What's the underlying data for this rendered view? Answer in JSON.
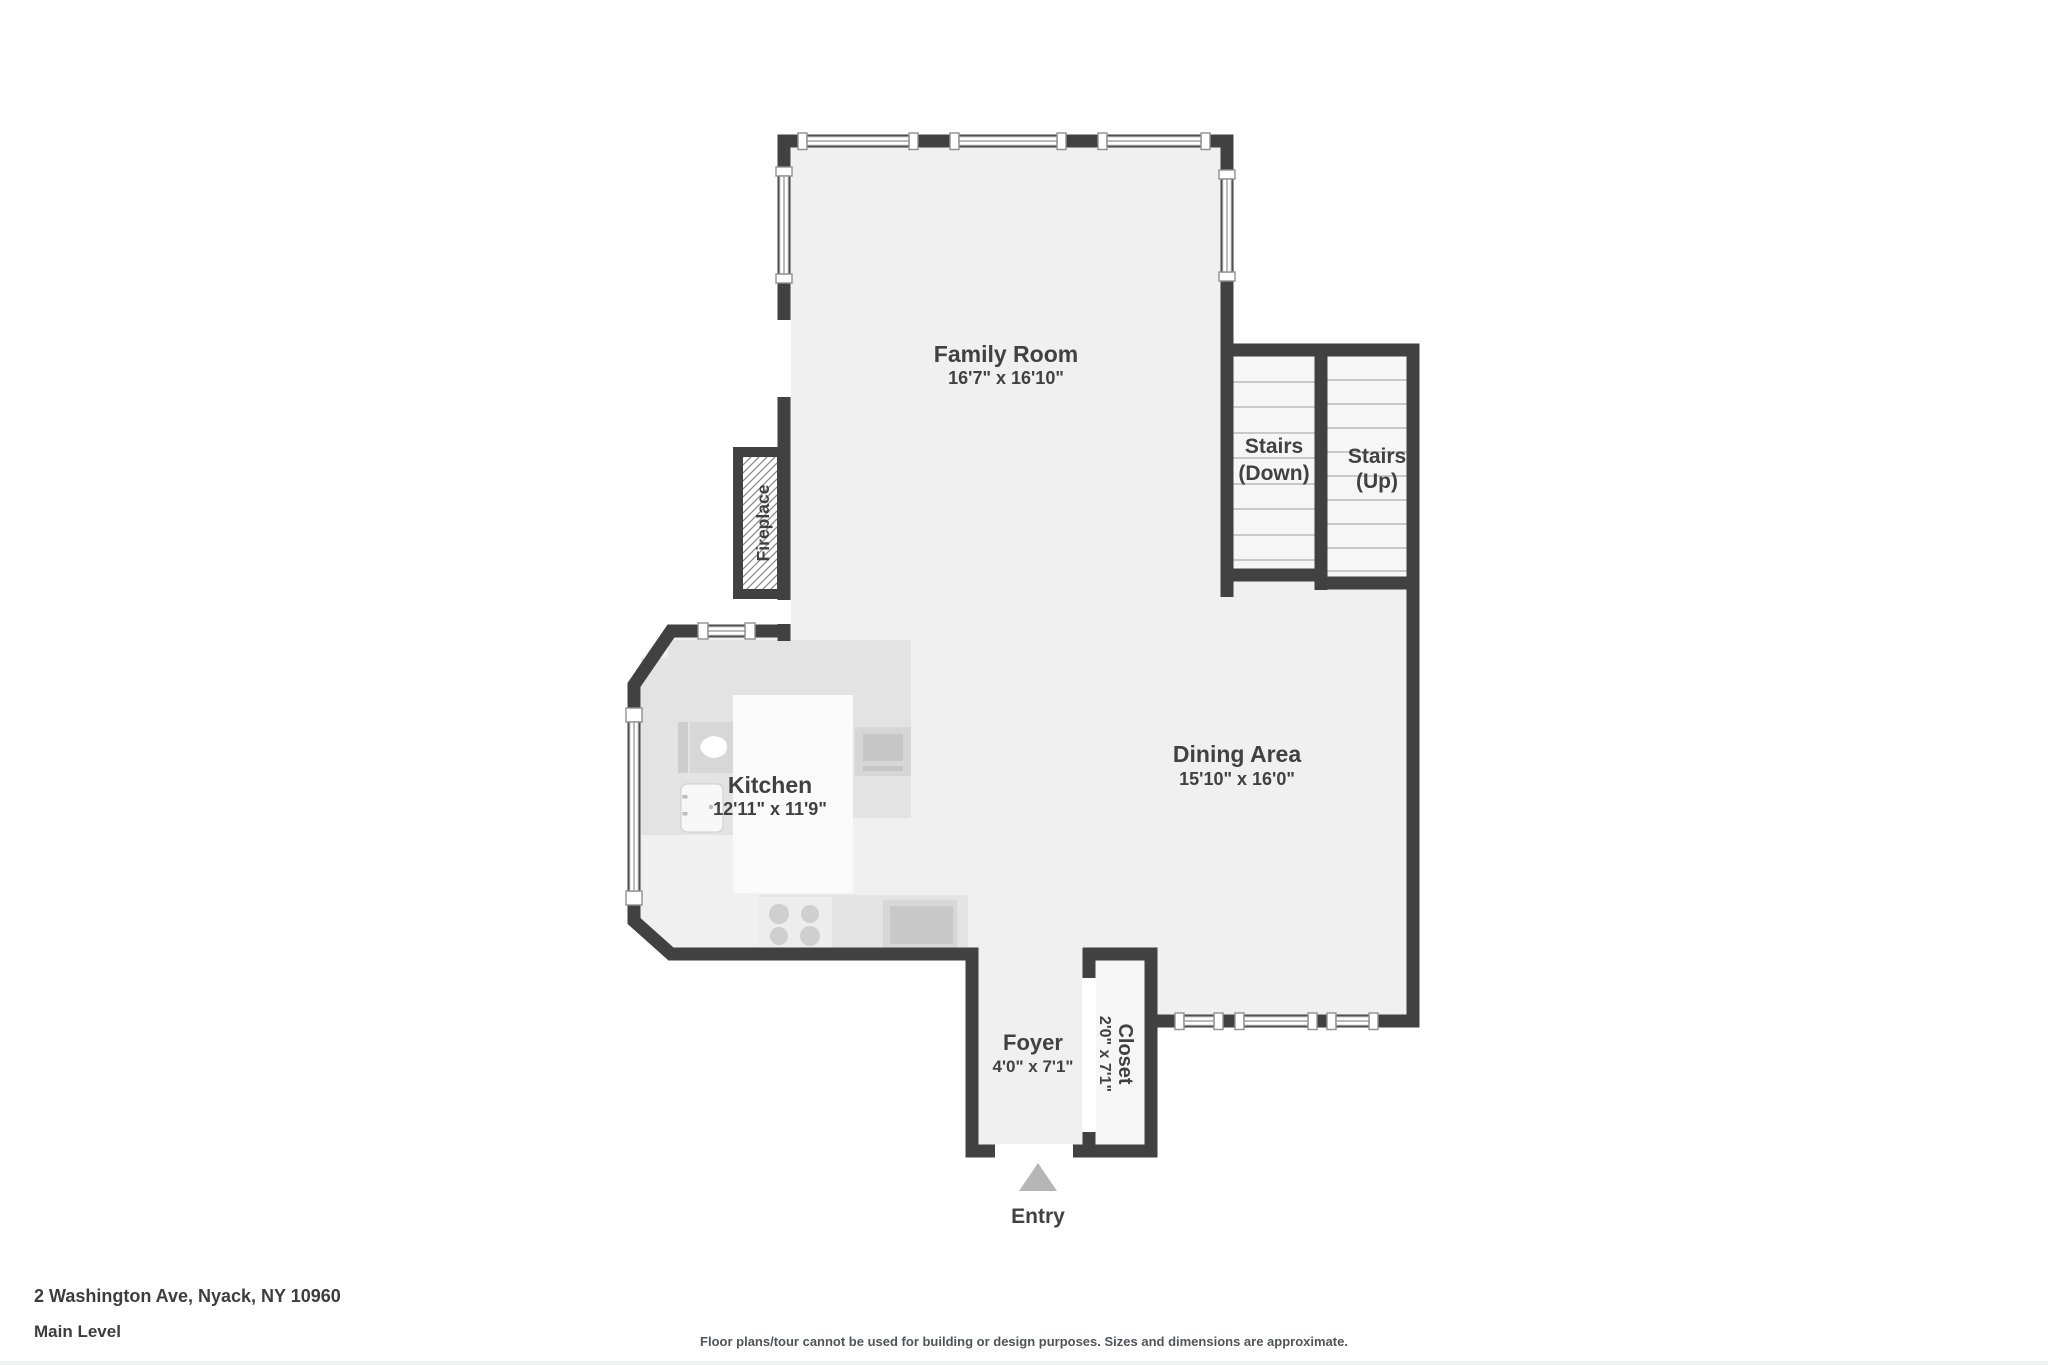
{
  "meta": {
    "address": "2 Washington Ave, Nyack, NY 10960",
    "level": "Main Level",
    "disclaimer": "Floor plans/tour cannot be used for building or design purposes. Sizes and dimensions are approximate."
  },
  "rooms": {
    "family_room": {
      "name": "Family Room",
      "dims": "16'7\" x 16'10\""
    },
    "stairs_down": {
      "line1": "Stairs",
      "line2": "(Down)"
    },
    "stairs_up": {
      "line1": "Stairs",
      "line2": "(Up)"
    },
    "dining_area": {
      "name": "Dining Area",
      "dims": "15'10\" x 16'0\""
    },
    "kitchen": {
      "name": "Kitchen",
      "dims": "12'11\" x 11'9\""
    },
    "foyer": {
      "name": "Foyer",
      "dims": "4'0\" x 7'1\""
    },
    "closet": {
      "name": "Closet",
      "dims": "2'0\" x 7'1\""
    },
    "fireplace": {
      "name": "Fireplace"
    },
    "entry": {
      "name": "Entry"
    }
  },
  "colors": {
    "wall": "#414141",
    "floor": "#f0f0f0",
    "stairs_floor": "#f6f6f6",
    "counter": "#e3e3e3",
    "label_text": "#414141",
    "entry_arrow": "#b6b6b6",
    "window_outline": "#909090"
  }
}
